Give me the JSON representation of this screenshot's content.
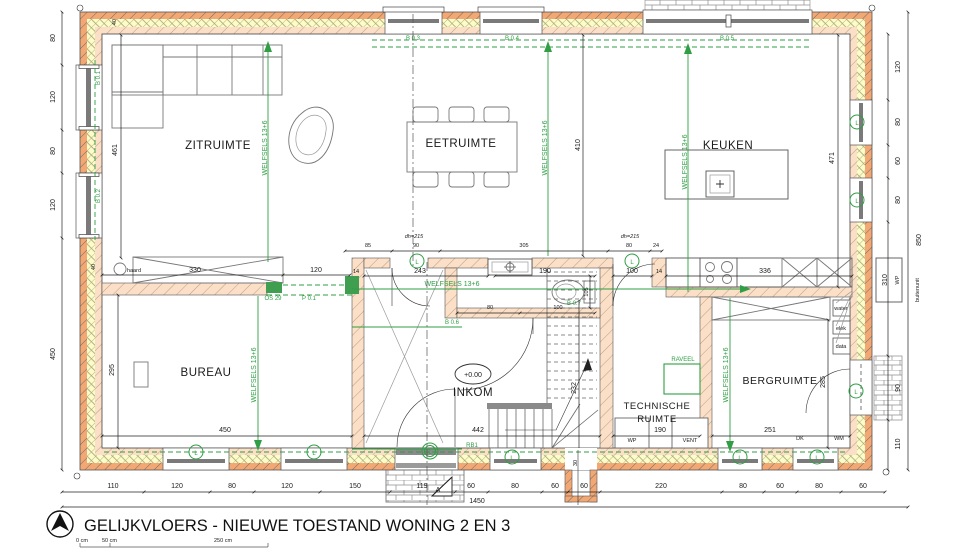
{
  "title": {
    "main": "GELIJKVLOERS - NIEUWE TOESTAND WONING 2 EN 3",
    "scale": [
      "0 cm",
      "50 cm",
      "250 cm"
    ]
  },
  "rooms": {
    "zitruimte": "ZITRUIMTE",
    "eetruimte": "EETRUIMTE",
    "keuken": "KEUKEN",
    "bureau": "BUREAU",
    "inkom": "INKOM",
    "technische_1": "TECHNISCHE",
    "technische_2": "RUIMTE",
    "bergruimte": "BERGRUIMTE",
    "level": "+0.00"
  },
  "codes": {
    "b01": "B 0.1",
    "b02": "B 0.2",
    "b03": "B 0.3",
    "b04": "B 0.4",
    "b05": "B 0.5",
    "b06": "B 0.6",
    "b07": "B 0.7",
    "p01": "P 0.1",
    "os29": "OS 29",
    "rb1": "RB1",
    "raveel": "RAVEEL",
    "welfsels": "WELFSELS 13+6"
  },
  "labels": {
    "haard": "haard",
    "wp": "WP",
    "vent": "VENT",
    "dk": "DK",
    "wm": "WM",
    "water": "water",
    "elek": "elek",
    "data": "data",
    "wp_unit": "WP",
    "buitenunit": "buitenunit",
    "dh215": "dh=215",
    "vent_mark": "L",
    "section_a": "A"
  },
  "dims": {
    "left": [
      "80",
      "120",
      "80",
      "120",
      "450"
    ],
    "right": [
      "120",
      "80",
      "60",
      "80"
    ],
    "right_outer": {
      "h850": "850",
      "h310": "310",
      "h90": "90",
      "h110": "110"
    },
    "bottom": [
      "110",
      "120",
      "80",
      "120",
      "150",
      "119",
      "60",
      "80",
      "60",
      "60",
      "220",
      "80",
      "60",
      "80",
      "60"
    ],
    "total": "1450",
    "inkom_top": [
      "85",
      "90",
      "305",
      "80",
      "24"
    ],
    "mid": {
      "a": "330",
      "b": "120",
      "c": "243",
      "d": "190",
      "e": "100",
      "f": "336",
      "g": "14",
      "h": "14"
    },
    "interior": {
      "zit_h": "461",
      "eet_h": "410",
      "keuken_h": "471",
      "bureau_h": "295",
      "bureau_w": "450",
      "inkom_w": "442",
      "stair": "232",
      "wc": "105",
      "wc_a": "80",
      "wc_b": "100",
      "berg_h": "285",
      "berg_w": "251",
      "tech_w": "190",
      "niche": "30",
      "wall_a": "40",
      "wall_b": "40"
    }
  },
  "colors": {
    "annotation_green": "#2f9e44",
    "wall_brick": "#f3a873",
    "wall_insulation": "#fcfccb",
    "wall_inner": "#fbdfc6"
  }
}
